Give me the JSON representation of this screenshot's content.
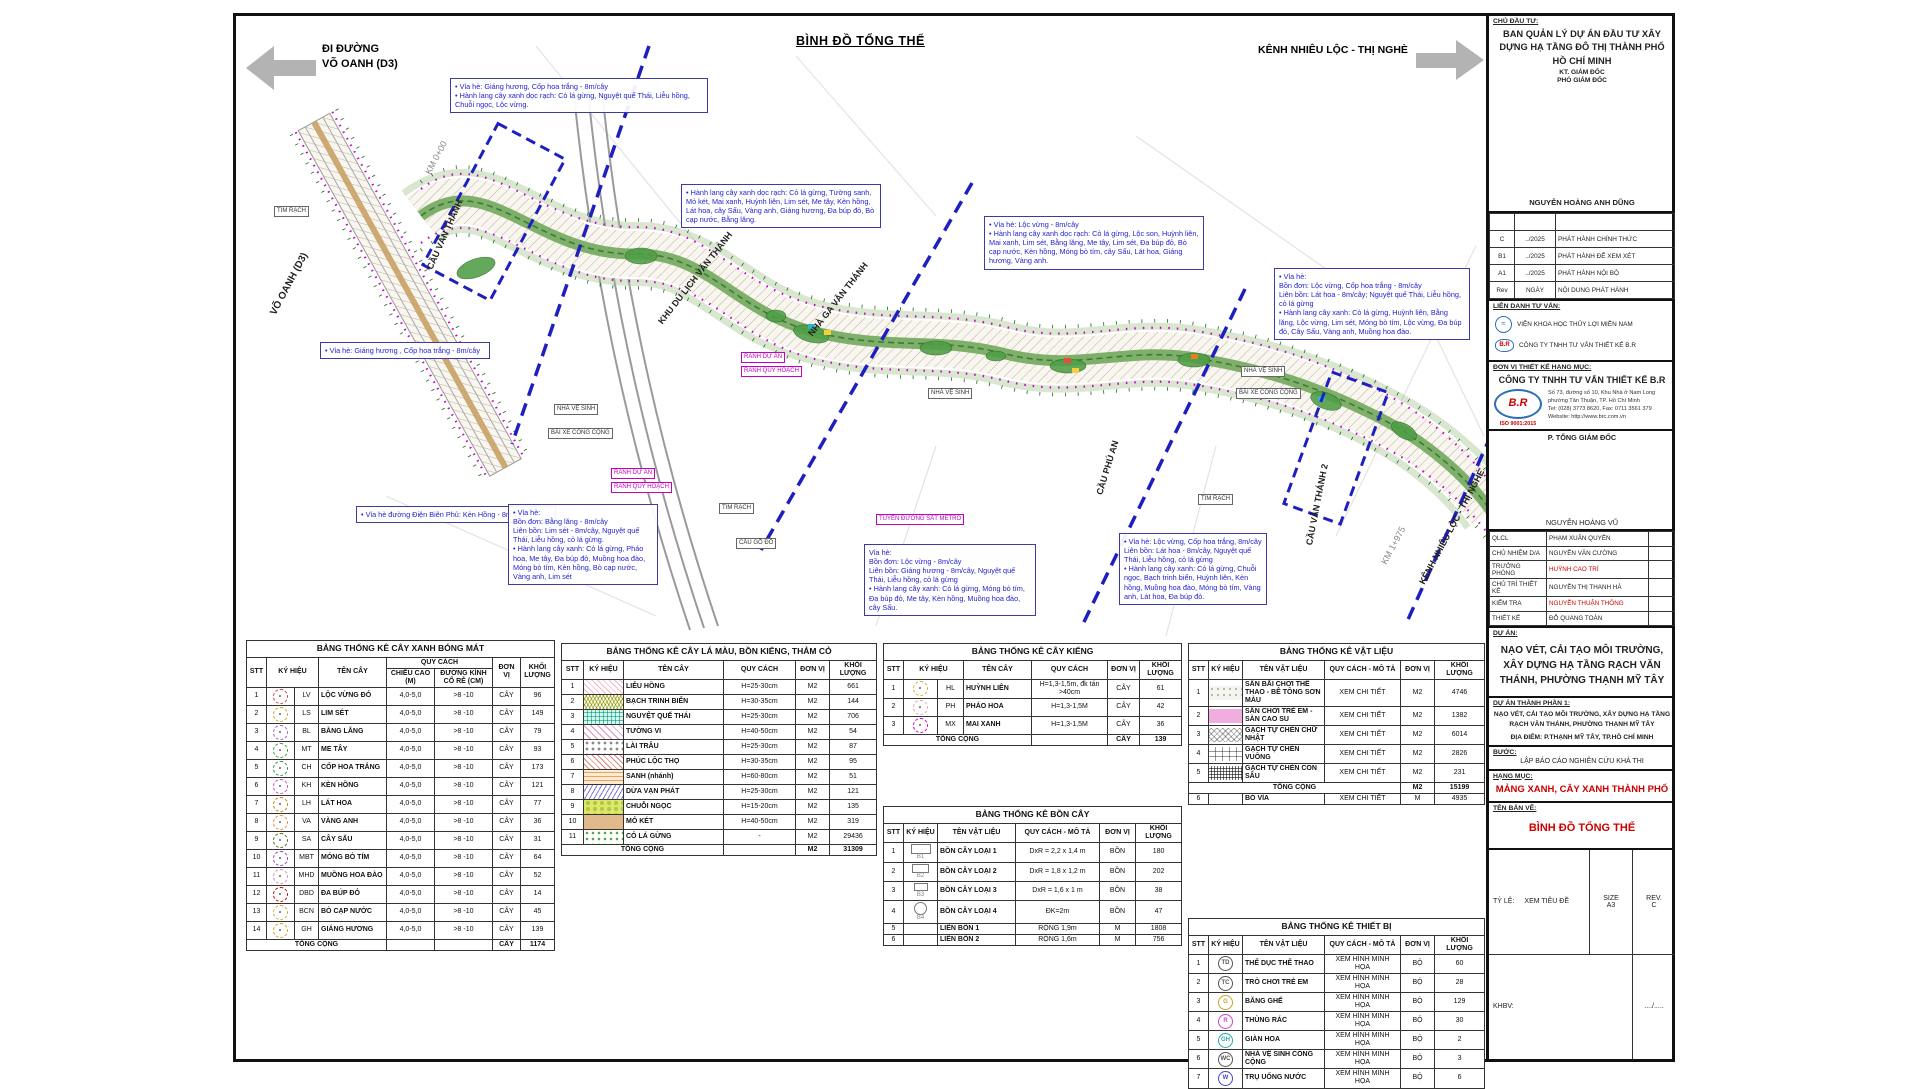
{
  "header": {
    "left_arrow_label": "ĐI ĐƯỜNG\nVÕ OANH (D3)",
    "title": "BÌNH ĐỒ TỔNG THỂ",
    "right_arrow_label": "KÊNH NHIÊU LỘC - THỊ NGHÈ"
  },
  "map": {
    "labels": {
      "vo_oanh": "VÕ OANH (D3)",
      "km0": "KM 0+00",
      "cau_van_thanh": "CẦU VĂN THÁNH",
      "khu_du_lich": "KHU DU LỊCH VĂN THÁNH",
      "nha_ga": "NHÀ GA VĂN THÁNH",
      "cau_phu_an": "CẦU PHÚ AN",
      "cau_van_thanh2": "CẦU VĂN THÁNH 2",
      "kenh": "KÊNH NHIÊU LỘC - THỊ NGHÈ",
      "km1975": "KM 1+975"
    },
    "boxes": [
      {
        "text": "TIM RẠCH"
      },
      {
        "text": "NHÀ VỆ SINH"
      },
      {
        "text": "BÃI XE CÔNG CỘNG"
      },
      {
        "text": "RANH DỰ ÁN"
      },
      {
        "text": "RANH QUY HOẠCH"
      },
      {
        "text": "RANH DỰ ÁN"
      },
      {
        "text": "RANH QUY HOẠCH"
      },
      {
        "text": "TIM RẠCH"
      },
      {
        "text": "CẦU GỖ ĐỎ"
      },
      {
        "text": "NHÀ VỆ SINH"
      },
      {
        "text": "TUYẾN ĐƯỜNG SẮT METRO"
      },
      {
        "text": "NHÀ VỆ SINH"
      },
      {
        "text": "BÃI XE CÔNG CỘNG"
      },
      {
        "text": "TIM RẠCH"
      }
    ],
    "callouts": [
      {
        "text": "• Vỉa hè: Giáng hương, Cốp hoa trắng - 8m/cây\n• Hành lang cây xanh dọc rạch: Cỏ lá gừng, Nguyệt quế Thái, Liễu hồng, Chuỗi ngọc, Lộc vừng."
      },
      {
        "text": "• Vỉa hè: Giáng hương , Cốp hoa trắng - 8m/cây"
      },
      {
        "text": "• Vỉa hè đường Điện Biên Phủ: Kèn Hồng - 8m/cây"
      },
      {
        "text": "• Hành lang cây xanh dọc rạch: Cỏ lá gừng, Tường sanh, Mỏ két, Mai xanh, Huỳnh liên, Lim sét, Me tây, Kèn hồng, Lát hoa, cây Sấu, Vàng anh, Giáng hương, Đa búp đỏ, Bò cạp nước, Bằng lăng."
      },
      {
        "text": "• Vỉa hè: Lộc vừng - 8m/cây\n• Hành lang cây xanh dọc rạch: Cỏ lá gừng, Lộc son, Huỳnh liên, Mai xanh, Lim sét, Bằng lăng, Me tây, Lim sét, Đa búp đỏ, Bò cạp nước, Kèn hồng, Móng bò tím, cây Sấu, Lát hoa, Giáng hương, Vàng anh."
      },
      {
        "text": "• Vỉa hè:\nBồn đơn: Lộc vừng, Cốp hoa trắng - 8m/cây\nLiên bồn: Lát hoa - 8m/cây; Nguyệt quế Thái, Liễu hồng, cỏ lá gừng\n• Hành lang cây xanh: Cỏ lá gừng, Huỳnh liên, Bằng lăng, Lộc vừng, Lim sét, Móng bò tím, Lộc vừng, Đa búp đỏ, Cây Sấu, Vàng anh, Muồng hoa đào."
      },
      {
        "text": "• Vỉa hè:\nBồn đơn: Bằng lăng - 8m/cây\nLiên bồn: Lim sét - 8m/cây, Nguyệt quế Thái, Liễu hồng, cỏ lá gừng.\n• Hành lang cây xanh: Cỏ lá gừng, Pháo hoa, Me tây, Đa búp đỏ, Muồng hoa đào, Móng bò tím, Kèn hồng, Bò cạp nước, Vàng anh, Lim sét"
      },
      {
        "text": "Vỉa hè:\nBồn đơn: Lộc vừng - 8m/cây\nLiên bồn: Giáng hương - 8m/cây, Nguyệt quế Thái, Liễu hồng, cỏ lá gừng\n• Hành lang cây xanh: Cỏ lá gừng, Móng bò tím, Đa búp đỏ, Me tây, Kèn hồng, Muồng hoa đào, cây Sấu."
      },
      {
        "text": "• Vỉa hè: Lộc vừng, Cốp hoa trắng, 8m/cây\nLiên bồn: Lát hoa - 8m/cây, Nguyệt quế Thái, Liễu hồng, cỏ lá gừng\n• Hành lang cây xanh: Cỏ lá gừng, Chuỗi ngọc, Bạch trinh biển, Huỳnh liên, Kèn hồng, Muồng hoa đào, Móng bò tím, Vàng anh, Lát hoa, Đa búp đỏ."
      }
    ]
  },
  "tables": {
    "t1": {
      "title": "BẢNG THỐNG KÊ CÂY XANH BÓNG MÁT",
      "headers": {
        "stt": "STT",
        "sym": "KÝ HIỆU",
        "name": "TÊN CÂY",
        "spec": "QUY CÁCH",
        "h": "CHIỀU CAO (M)",
        "d": "ĐƯỜNG KÍNH CỔ RỄ (CM)",
        "unit": "ĐƠN VỊ",
        "qty": "KHỐI LƯỢNG"
      },
      "rows": [
        {
          "stt": "1",
          "code": "LV",
          "name": "LỘC VỪNG ĐỎ",
          "h": "4,0-5,0",
          "d": ">8 -10",
          "unit": "CÂY",
          "qty": "96",
          "color": "#cc4444"
        },
        {
          "stt": "2",
          "code": "LS",
          "name": "LIM SÉT",
          "h": "4,0-5,0",
          "d": ">8 -10",
          "unit": "CÂY",
          "qty": "149",
          "color": "#c9a227"
        },
        {
          "stt": "3",
          "code": "BL",
          "name": "BẰNG LĂNG",
          "h": "4,0-5,0",
          "d": ">8 -10",
          "unit": "CÂY",
          "qty": "79",
          "color": "#a05cc9"
        },
        {
          "stt": "4",
          "code": "MT",
          "name": "ME TÂY",
          "h": "4,0-5,0",
          "d": ">8 -10",
          "unit": "CÂY",
          "qty": "93",
          "color": "#3f9d3f"
        },
        {
          "stt": "5",
          "code": "CH",
          "name": "CỐP HOA TRẮNG",
          "h": "4,0-5,0",
          "d": ">8 -10",
          "unit": "CÂY",
          "qty": "173",
          "color": "#2f8f4e"
        },
        {
          "stt": "6",
          "code": "KH",
          "name": "KÈN HỒNG",
          "h": "4,0-5,0",
          "d": ">8 -10",
          "unit": "CÂY",
          "qty": "121",
          "color": "#cc44cc"
        },
        {
          "stt": "7",
          "code": "LH",
          "name": "LÁT HOA",
          "h": "4,0-5,0",
          "d": ">8 -10",
          "unit": "CÂY",
          "qty": "77",
          "color": "#b8860b"
        },
        {
          "stt": "8",
          "code": "VA",
          "name": "VÀNG ANH",
          "h": "4,0-5,0",
          "d": ">8 -10",
          "unit": "CÂY",
          "qty": "36",
          "color": "#e69138"
        },
        {
          "stt": "9",
          "code": "SA",
          "name": "CÂY SẤU",
          "h": "4,0-5,0",
          "d": ">8 -10",
          "unit": "CÂY",
          "qty": "31",
          "color": "#38761d"
        },
        {
          "stt": "10",
          "code": "MBT",
          "name": "MÓNG BÒ TÍM",
          "h": "4,0-5,0",
          "d": ">8 -10",
          "unit": "CÂY",
          "qty": "64",
          "color": "#8e44ad"
        },
        {
          "stt": "11",
          "code": "MHD",
          "name": "MUỒNG HOA ĐÀO",
          "h": "4,0-5,0",
          "d": ">8 -10",
          "unit": "CÂY",
          "qty": "52",
          "color": "#d98cb3"
        },
        {
          "stt": "12",
          "code": "DBD",
          "name": "ĐA BÚP ĐỎ",
          "h": "4,0-5,0",
          "d": ">8 -10",
          "unit": "CÂY",
          "qty": "14",
          "color": "#cc0000"
        },
        {
          "stt": "13",
          "code": "BCN",
          "name": "BÒ CẠP NƯỚC",
          "h": "4,0-5,0",
          "d": ">8 -10",
          "unit": "CÂY",
          "qty": "45",
          "color": "#c9b037"
        },
        {
          "stt": "14",
          "code": "GH",
          "name": "GIÁNG HƯƠNG",
          "h": "4,0-5,0",
          "d": ">8 -10",
          "unit": "CÂY",
          "qty": "139",
          "color": "#d4a017"
        }
      ],
      "total": {
        "label": "TỔNG CỘNG",
        "unit": "CÂY",
        "qty": "1174"
      }
    },
    "t2": {
      "title": "BẢNG THỐNG KÊ CÂY LÁ MÀU, BỒN KIỂNG, THẢM CỎ",
      "headers": {
        "stt": "STT",
        "sym": "KÝ HIỆU",
        "name": "TÊN CÂY",
        "spec": "QUY CÁCH",
        "unit": "ĐƠN VỊ",
        "qty": "KHỐI LƯỢNG"
      },
      "rows": [
        {
          "stt": "1",
          "name": "LIỄU HỒNG",
          "spec": "H=25-30cm",
          "unit": "M2",
          "qty": "661",
          "sym": "hash-pink"
        },
        {
          "stt": "2",
          "name": "BẠCH TRINH BIỂN",
          "spec": "H=30-35cm",
          "unit": "M2",
          "qty": "144",
          "sym": "tri-olive"
        },
        {
          "stt": "3",
          "name": "NGUYỆT QUẾ THÁI",
          "spec": "H=25-30cm",
          "unit": "M2",
          "qty": "706",
          "sym": "grid-teal"
        },
        {
          "stt": "4",
          "name": "TƯỜNG VI",
          "spec": "H=40-50cm",
          "unit": "M2",
          "qty": "54",
          "sym": "diag-pink"
        },
        {
          "stt": "5",
          "name": "LÀI TRÂU",
          "spec": "H=25-30cm",
          "unit": "M2",
          "qty": "87",
          "sym": "rings-gray"
        },
        {
          "stt": "6",
          "name": "PHÚC LỘC THỌ",
          "spec": "H=30-35cm",
          "unit": "M2",
          "qty": "95",
          "sym": "diag-red"
        },
        {
          "stt": "7",
          "name": "SANH (nhánh)",
          "spec": "H=60-80cm",
          "unit": "M2",
          "qty": "51",
          "sym": "dash-orange"
        },
        {
          "stt": "8",
          "name": "DỪA VẠN PHÁT",
          "spec": "H=25-30cm",
          "unit": "M2",
          "qty": "121",
          "sym": "zig-blue"
        },
        {
          "stt": "9",
          "name": "CHUỖI NGỌC",
          "spec": "H=15-20cm",
          "unit": "M2",
          "qty": "135",
          "sym": "blotch-yg"
        },
        {
          "stt": "10",
          "name": "MỎ KÉT",
          "spec": "H=40-50cm",
          "unit": "M2",
          "qty": "319",
          "sym": "solid-tan"
        },
        {
          "stt": "11",
          "name": "CỎ LÁ GỪNG",
          "spec": "-",
          "unit": "M2",
          "qty": "29436",
          "sym": "dots-green"
        }
      ],
      "total": {
        "label": "TỔNG CỘNG",
        "unit": "M2",
        "qty": "31309"
      }
    },
    "t3": {
      "title": "BẢNG THỐNG KÊ CÂY KIỂNG",
      "headers": {
        "stt": "STT",
        "sym": "KÝ HIỆU",
        "name": "TÊN CÂY",
        "spec": "QUY CÁCH",
        "unit": "ĐƠN VỊ",
        "qty": "KHỐI LƯỢNG"
      },
      "rows": [
        {
          "stt": "1",
          "code": "HL",
          "name": "HUỲNH LIÊN",
          "spec": "H=1,3-1,5m, đk tán >40cm",
          "unit": "CÂY",
          "qty": "61",
          "color": "#cfae3a"
        },
        {
          "stt": "2",
          "code": "PH",
          "name": "PHÁO HOA",
          "spec": "H=1,3-1,5M",
          "unit": "CÂY",
          "qty": "42",
          "color": "#e8a0bf"
        },
        {
          "stt": "3",
          "code": "MX",
          "name": "MAI XANH",
          "spec": "H=1,3-1,5M",
          "unit": "CÂY",
          "qty": "36",
          "color": "#cc00cc"
        }
      ],
      "total": {
        "label": "TỔNG CỘNG",
        "unit": "CÂY",
        "qty": "139"
      }
    },
    "t4": {
      "title": "BẢNG THỐNG KÊ BỒN CÂY",
      "headers": {
        "stt": "STT",
        "sym": "KÝ HIỆU",
        "name": "TÊN VẬT LIỆU",
        "spec": "QUY CÁCH - MÔ TẢ",
        "unit": "ĐƠN VỊ",
        "qty": "KHỐI LƯỢNG"
      },
      "rows": [
        {
          "stt": "1",
          "code": "B1",
          "shape": "r1",
          "name": "BỒN CÂY LOẠI 1",
          "spec": "DxR = 2,2 x 1,4 m",
          "unit": "BỒN",
          "qty": "180"
        },
        {
          "stt": "2",
          "code": "B2",
          "shape": "r2",
          "name": "BỒN CÂY LOẠI 2",
          "spec": "DxR = 1,8 x 1,2 m",
          "unit": "BỒN",
          "qty": "202"
        },
        {
          "stt": "3",
          "code": "B3",
          "shape": "r3",
          "name": "BỒN CÂY LOẠI 3",
          "spec": "DxR = 1,6 x 1 m",
          "unit": "BỒN",
          "qty": "38"
        },
        {
          "stt": "4",
          "code": "B4",
          "shape": "c1",
          "name": "BỒN CÂY LOẠI 4",
          "spec": "ĐK=2m",
          "unit": "BỒN",
          "qty": "47"
        },
        {
          "stt": "5",
          "code": "",
          "shape": "",
          "name": "LIÊN BỒN 1",
          "spec": "RỘNG 1,9m",
          "unit": "M",
          "qty": "1808"
        },
        {
          "stt": "6",
          "code": "",
          "shape": "",
          "name": "LIÊN BỒN 2",
          "spec": "RỘNG 1,6m",
          "unit": "M",
          "qty": "756"
        }
      ]
    },
    "t5": {
      "title": "BẢNG THỐNG KÊ VẬT LIỆU",
      "headers": {
        "stt": "STT",
        "sym": "KÝ HIỆU",
        "name": "TÊN VẬT LIỆU",
        "spec": "QUY CÁCH - MÔ TẢ",
        "unit": "ĐƠN VỊ",
        "qty": "KHỐI LƯỢNG"
      },
      "rows": [
        {
          "stt": "1",
          "name": "SÂN BÃI CHƠI THỂ THAO - BÊ TÔNG SƠN MÀU",
          "spec": "XEM CHI TIẾT",
          "unit": "M2",
          "qty": "4746",
          "sym": "dots-white"
        },
        {
          "stt": "2",
          "name": "SÂN CHƠI TRẺ EM - SÀN CAO SU",
          "spec": "XEM CHI TIẾT",
          "unit": "M2",
          "qty": "1382",
          "sym": "solid-pink"
        },
        {
          "stt": "3",
          "name": "GẠCH TỰ CHÈN CHỮ NHẬT",
          "spec": "XEM CHI TIẾT",
          "unit": "M2",
          "qty": "6014",
          "sym": "herring-gray"
        },
        {
          "stt": "4",
          "name": "GẠCH TỰ CHÈN VUÔNG",
          "spec": "XEM CHI TIẾT",
          "unit": "M2",
          "qty": "2826",
          "sym": "brick-gray"
        },
        {
          "stt": "5",
          "name": "GẠCH TỰ CHÈN CON SÂU",
          "spec": "XEM CHI TIẾT",
          "unit": "M2",
          "qty": "231",
          "sym": "grid-dark"
        }
      ],
      "total": {
        "label": "TỔNG CỘNG",
        "unit": "M2",
        "qty": "15199"
      },
      "extra": {
        "stt": "6",
        "name": "BÓ VỈA",
        "spec": "XEM CHI TIẾT",
        "unit": "M",
        "qty": "4935"
      }
    },
    "t6": {
      "title": "BẢNG THỐNG KÊ THIẾT BỊ",
      "headers": {
        "stt": "STT",
        "sym": "KÝ HIỆU",
        "name": "TÊN VẬT LIỆU",
        "spec": "QUY CÁCH - MÔ TẢ",
        "unit": "ĐƠN VỊ",
        "qty": "KHỐI LƯỢNG"
      },
      "rows": [
        {
          "stt": "1",
          "code": "TD",
          "name": "THỂ DỤC THỂ THAO",
          "spec": "XEM HÌNH MINH HỌA",
          "unit": "BỘ",
          "qty": "60",
          "color": "#555555"
        },
        {
          "stt": "2",
          "code": "TC",
          "name": "TRÒ CHƠI TRẺ EM",
          "spec": "XEM HÌNH MINH HỌA",
          "unit": "BỘ",
          "qty": "28",
          "color": "#555555"
        },
        {
          "stt": "3",
          "code": "G",
          "name": "BĂNG GHẾ",
          "spec": "XEM HÌNH MINH HỌA",
          "unit": "BỘ",
          "qty": "129",
          "color": "#c9a227"
        },
        {
          "stt": "4",
          "code": "R",
          "name": "THÙNG RÁC",
          "spec": "XEM HÌNH MINH HỌA",
          "unit": "BỘ",
          "qty": "30",
          "color": "#cc44cc"
        },
        {
          "stt": "5",
          "code": "GH",
          "name": "GIÀN HOA",
          "spec": "XEM HÌNH MINH HỌA",
          "unit": "BỘ",
          "qty": "2",
          "color": "#2aa9a9"
        },
        {
          "stt": "6",
          "code": "WC",
          "name": "NHÀ VỆ SINH CÔNG CỘNG",
          "spec": "XEM HÌNH MINH HỌA",
          "unit": "BỘ",
          "qty": "3",
          "color": "#555555"
        },
        {
          "stt": "7",
          "code": "W",
          "name": "TRỤ UỐNG NƯỚC",
          "spec": "XEM HÌNH MINH HỌA",
          "unit": "BỘ",
          "qty": "6",
          "color": "#4444cc"
        }
      ]
    }
  },
  "tb": {
    "owner": {
      "label": "CHỦ ĐẦU TƯ:",
      "name": "BAN QUẢN LÝ DỰ ÁN ĐẦU TƯ XÂY DỰNG HẠ TẦNG ĐÔ THỊ THÀNH PHỐ HỒ CHÍ MINH",
      "role1": "KT. GIÁM ĐỐC",
      "role2": "PHÓ GIÁM ĐỐC",
      "signer": "NGUYỄN HOÀNG ANH DŨNG"
    },
    "revisions": [
      {
        "c1": "",
        "c2": "",
        "c3": ""
      },
      {
        "c1": "C",
        "c2": "../2025",
        "c3": "PHÁT HÀNH CHÍNH THỨC"
      },
      {
        "c1": "B1",
        "c2": "../2025",
        "c3": "PHÁT HÀNH ĐỂ XEM XÉT"
      },
      {
        "c1": "A1",
        "c2": "../2025",
        "c3": "PHÁT HÀNH NỘI BỘ"
      },
      {
        "c1": "Rev",
        "c2": "NGÀY",
        "c3": "NỘI DUNG PHÁT HÀNH"
      }
    ],
    "lien_danh": {
      "label": "LIÊN DANH TƯ VẤN:",
      "p1": "VIỆN KHOA HỌC THỦY LỢI MIỀN NAM",
      "p2": "CÔNG TY TNHH TƯ VẤN THIẾT KẾ B.R"
    },
    "unit_design": {
      "label": "ĐƠN VỊ THIẾT KẾ HẠNG MỤC:",
      "company": "CÔNG TY TNHH TƯ VẤN THIẾT KẾ B.R",
      "logo_text": "B.R",
      "iso": "ISO 9001:2015",
      "addr1": "Số 73, đường số 10, Khu Nhà ở Nam Long phường Tân Thuận, TP. Hồ Chí Minh",
      "addr2": "Tel: (028) 3773 8620, Fax: 0711 3561 379",
      "addr3": "Website: http://www.brc.com.vn"
    },
    "ptgd": {
      "label": "P. TỔNG GIÁM ĐỐC",
      "signer": "NGUYỄN HOÀNG VŨ"
    },
    "personnel": [
      {
        "role": "QLCL",
        "name": "PHẠM XUÂN QUYỀN",
        "red": "0"
      },
      {
        "role": "CHỦ NHIỆM D/A",
        "name": "NGUYỄN VĂN CƯỜNG",
        "red": "0"
      },
      {
        "role": "TRƯỞNG PHÒNG",
        "name": "HUỲNH CAO TRÍ",
        "red": "1"
      },
      {
        "role": "CHỦ TRÌ THIẾT KẾ",
        "name": "NGUYỄN THỊ THANH HÀ",
        "red": "0"
      },
      {
        "role": "KIỂM TRA",
        "name": "NGUYỄN THUẬN THÔNG",
        "red": "1"
      },
      {
        "role": "THIẾT KẾ",
        "name": "ĐỖ QUANG TOÀN",
        "red": "0"
      }
    ],
    "du_an": {
      "label": "DỰ ÁN:",
      "name": "NẠO VÉT, CẢI TẠO MÔI TRƯỜNG, XÂY DỰNG HẠ TẦNG RẠCH VĂN THÁNH, PHƯỜNG THẠNH MỸ TÂY"
    },
    "thanh_phan": {
      "label": "DỰ ÁN THÀNH PHẦN 1:",
      "name": "NẠO VÉT, CẢI TẠO MÔI TRƯỜNG, XÂY DỰNG HẠ TẦNG RẠCH VĂN THÁNH, PHƯỜNG THẠNH MỸ TÂY",
      "place": "ĐỊA ĐIỂM: P.THẠNH MỸ TÂY, TP.HỒ CHÍ MINH"
    },
    "buoc": {
      "label": "BƯỚC:",
      "name": "LẬP BÁO CÁO NGHIÊN CỨU KHẢ THI"
    },
    "hang_muc": {
      "label": "HẠNG MỤC:",
      "name": "MẢNG XANH, CÂY XANH THÀNH PHỐ"
    },
    "ten_ban_ve": {
      "label": "TÊN BẢN VẼ:",
      "name": "BÌNH ĐỒ TỔNG THỂ"
    },
    "footer": {
      "scale_label": "TỶ LỆ:",
      "scale": "XEM TIÊU ĐỀ",
      "size_label": "SIZE",
      "size": "A3",
      "rev_label": "REV.",
      "rev": "C",
      "khbv_label": "KHBV:",
      "khbv": "..../....."
    }
  }
}
